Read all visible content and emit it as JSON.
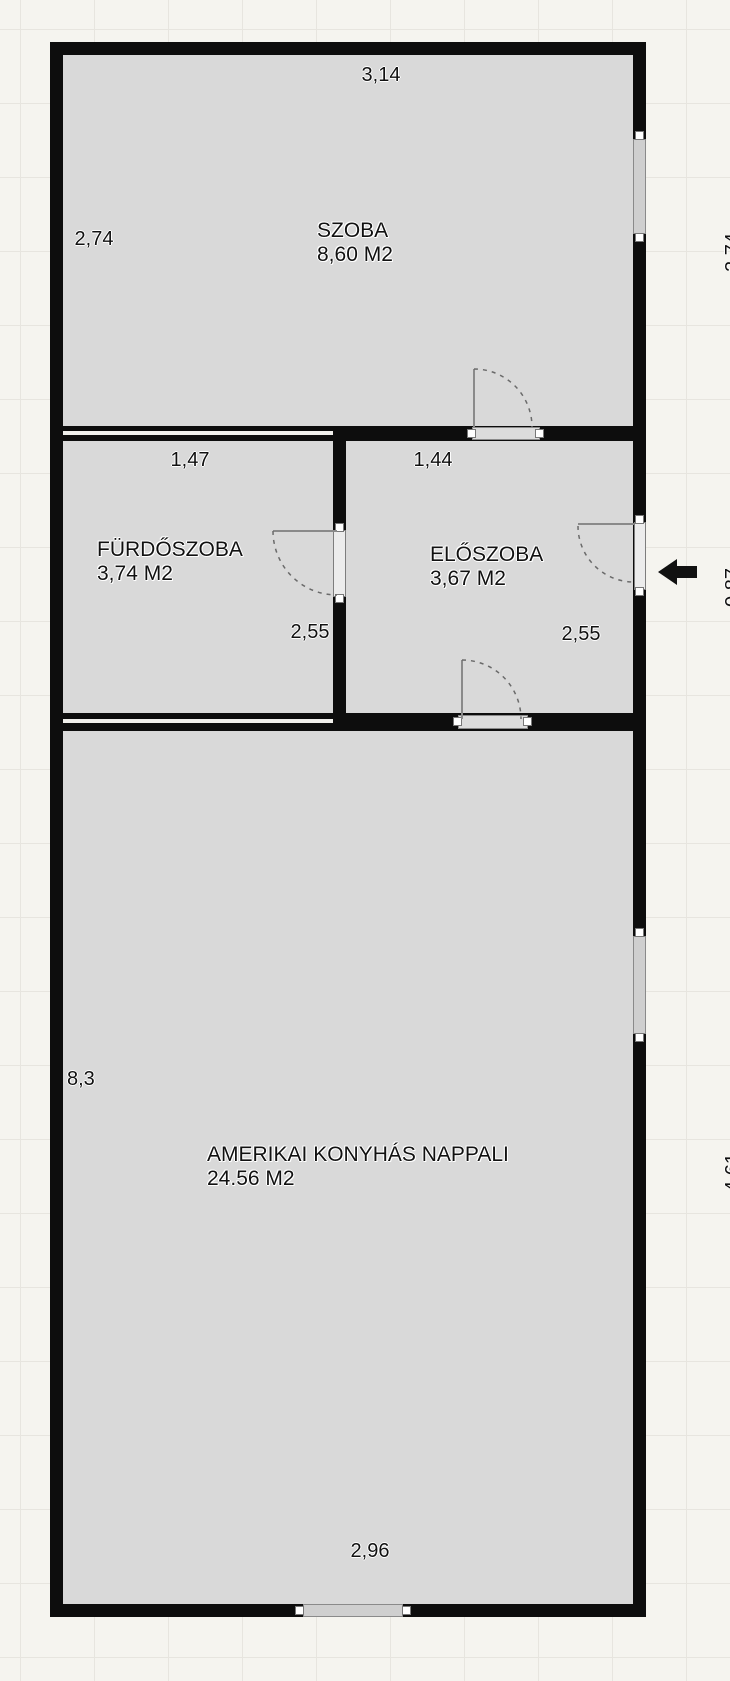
{
  "floorplan": {
    "rooms": {
      "szoba": {
        "name": "SZOBA",
        "area": "8,60 M2",
        "width": "3,14",
        "height": "2,74"
      },
      "furdoszoba": {
        "name": "FÜRDŐSZOBA",
        "area": "3,74 M2",
        "width": "1,47",
        "height": "2,55"
      },
      "eloszoba": {
        "name": "ELŐSZOBA",
        "area": "3,67 M2",
        "width": "1,44",
        "height": "2,55"
      },
      "nappali": {
        "name": "AMERIKAI KONYHÁS NAPPALI",
        "area": "24.56 M2",
        "width": "2,96",
        "height": "8,3"
      }
    },
    "clipped_right_dims": {
      "top": "2,74",
      "middle": "0,87",
      "bottom": "4,61"
    },
    "entrance": {
      "arrow_direction": "left"
    },
    "colors": {
      "wall": "#0d0d0d",
      "room_fill": "#d9d9d9",
      "background": "#f5f4ef",
      "grid_line": "#e7e5df",
      "window_fill": "#cfcfcf"
    }
  }
}
